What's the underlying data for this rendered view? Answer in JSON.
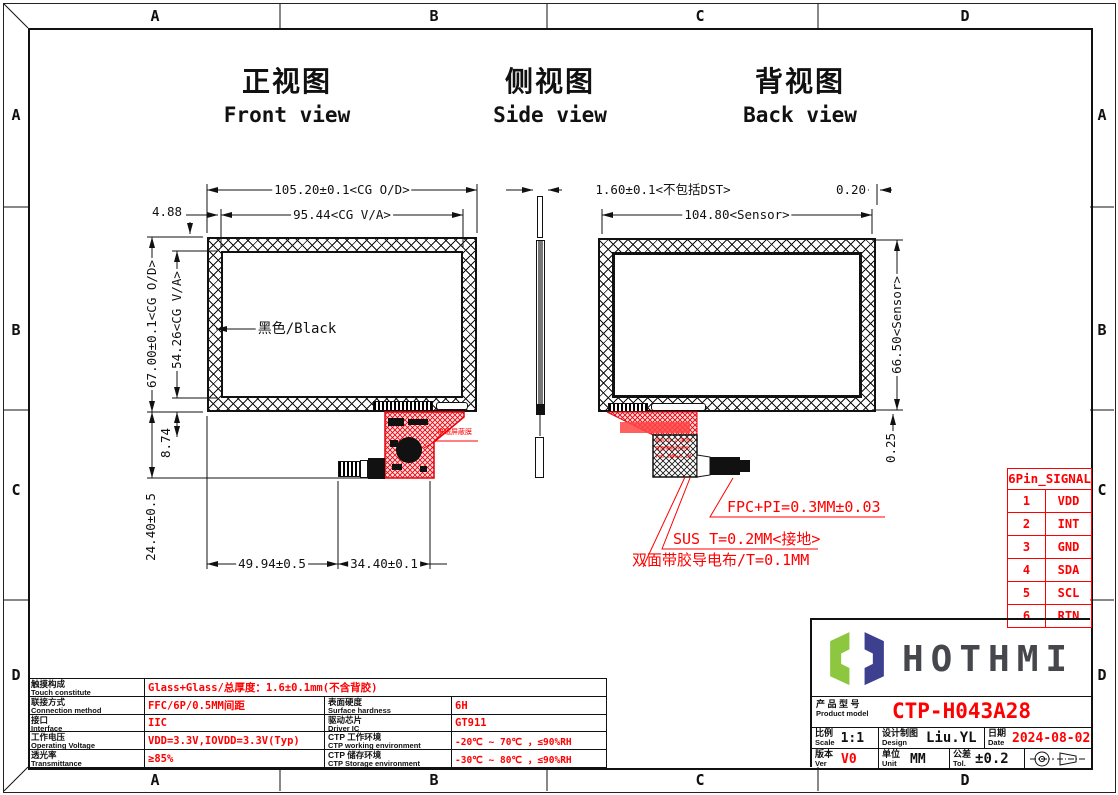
{
  "drawing": {
    "border_zones": [
      "A",
      "B",
      "C",
      "D"
    ],
    "views": {
      "front": {
        "title_cn": "正视图",
        "title_en": "Front view",
        "dims": {
          "od_w": "105.20±0.1<CG O/D>",
          "va_w": "95.44<CG V/A>",
          "offset": "4.88",
          "od_h": "67.00±0.1<CG O/D>",
          "va_h": "54.26<CG V/A>",
          "fpc_offset": "8.74",
          "fpc_len": "24.40±0.5",
          "bottom_left": "49.94±0.5",
          "bottom_right": "34.40±0.1"
        },
        "labels": {
          "black": "黑色/Black",
          "shield": "电磁屏蔽膜"
        }
      },
      "side": {
        "title_cn": "侧视图",
        "title_en": "Side view",
        "dims": {
          "thickness": "1.60±0.1<不包括DST>"
        }
      },
      "back": {
        "title_cn": "背视图",
        "title_en": "Back view",
        "dims": {
          "sensor_w": "104.80<Sensor>",
          "edge_gap": "0.20",
          "sensor_h": "66.50<Sensor>",
          "bottom_gap": "0.25"
        },
        "notes": {
          "fpc": "FPC+PI=0.3MM±0.03",
          "sus": "SUS T=0.2MM<接地>",
          "tape": "双面带胶导电布/T=0.1MM",
          "inner1": "钢片t0.2<接地>",
          "inner2": "双面带胶导电布",
          "inner3": "T=0.2MM±0.1M"
        }
      }
    }
  },
  "pin_table": {
    "title": "6Pin_SIGNAL",
    "rows": [
      {
        "pin": "1",
        "signal": "VDD"
      },
      {
        "pin": "2",
        "signal": "INT"
      },
      {
        "pin": "3",
        "signal": "GND"
      },
      {
        "pin": "4",
        "signal": "SDA"
      },
      {
        "pin": "5",
        "signal": "SCL"
      },
      {
        "pin": "6",
        "signal": "RTN"
      }
    ]
  },
  "spec_table": {
    "rows": [
      {
        "label_cn": "触摸构成",
        "label_en": "Touch constitute",
        "value": "Glass+Glass/总厚度：1.6±0.1mm(不含背胶)",
        "label2_cn": "",
        "label2_en": "",
        "value2": ""
      },
      {
        "label_cn": "联接方式",
        "label_en": "Connection method",
        "value": "FFC/6P/0.5MM间距",
        "label2_cn": "表面硬度",
        "label2_en": "Surface hardness",
        "value2": "6H"
      },
      {
        "label_cn": "接口",
        "label_en": "Interface",
        "value": "IIC",
        "label2_cn": "驱动芯片",
        "label2_en": "Driver IC",
        "value2": "GT911"
      },
      {
        "label_cn": "工作电压",
        "label_en": "Operating Voltage",
        "value": "VDD=3.3V,IOVDD=3.3V(Typ)",
        "label2_cn": "CTP 工作环境",
        "label2_en": "CTP working environment",
        "value2": "-20℃ ~ 70℃ ，≤90%RH"
      },
      {
        "label_cn": "透光率",
        "label_en": "Transmittance",
        "value": "≥85%",
        "label2_cn": "CTP 储存环境",
        "label2_en": "CTP Storage environment",
        "value2": "-30℃ ~ 80℃ ，≤90%RH"
      }
    ]
  },
  "title_block": {
    "logo_text": "HOTHMI",
    "product_label_cn": "产 品 型 号",
    "product_label_en": "Product model",
    "product_model": "CTP-H043A28",
    "scale_cn": "比例",
    "scale_en": "Scale",
    "scale_val": "1:1",
    "design_cn": "设计制图",
    "design_en": "Design",
    "design_val": "Liu.YL",
    "date_cn": "日期",
    "date_en": "Date",
    "date_val": "2024-08-02",
    "ver_cn": "版本",
    "ver_en": "Ver",
    "ver_val": "V0",
    "unit_cn": "单位",
    "unit_en": "Unit",
    "unit_val": "MM",
    "tol_cn": "公差",
    "tol_en": "Tol.",
    "tol_val": "±0.2"
  },
  "colors": {
    "red": "#ff0000",
    "logo_green": "#8dc63f",
    "logo_navy": "#3d3f8f"
  }
}
